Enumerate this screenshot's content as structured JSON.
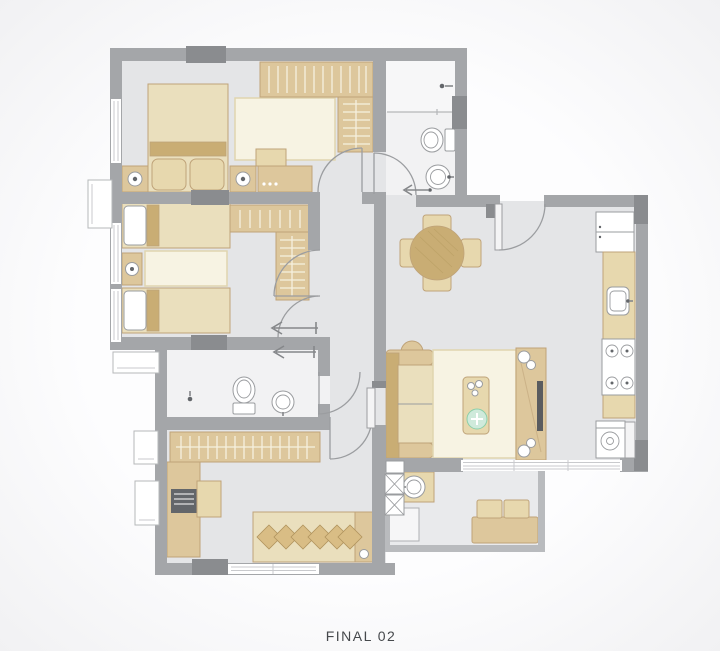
{
  "title": {
    "label": "FINAL 02"
  },
  "colors": {
    "background": "#fdfdfe",
    "backgroundEdge": "#f1f1f3",
    "wall": "#a4a6a9",
    "wallDark": "#8a8c8f",
    "wallLight": "#b9bbbe",
    "floor": "#e4e5e7",
    "floorBalcony": "#e9eaec",
    "bathFloor": "#f2f2f3",
    "showerFloor": "#f7f7f8",
    "tan": "#ddc79c",
    "tanLight": "#eadfbd",
    "tanPale": "#e7d8ae",
    "tanDark": "#c9ad74",
    "tanStroke": "#bfa379",
    "cream": "#f7f3e3",
    "creamStroke": "#e0d5af",
    "fixture": "#9a9c9f",
    "door": "#9b9da0",
    "hanger": "#f6f1df",
    "tableHatch": "#b59a5e",
    "pillow": "#d9bd85",
    "pillowStroke": "#b1945e",
    "plant": "#cfeadb",
    "plantDark": "#8bcfa9",
    "tv": "#5a5c5f",
    "dark": "#63666a",
    "arrow": "#85878a",
    "text": "#46494c"
  },
  "legend": {
    "rooms": [
      "bedroom-1",
      "bedroom-2",
      "bedroom-3",
      "bathroom-1",
      "bathroom-2",
      "hall",
      "dining-area",
      "living-room",
      "kitchen",
      "balcony"
    ],
    "icons": [
      "double-bed-icon",
      "single-bed-icon",
      "wardrobe-icon",
      "nightstand-icon",
      "table-lamp-icon",
      "rug-icon",
      "dresser-icon",
      "toilet-icon",
      "washbasin-icon",
      "shower-head-icon",
      "round-dining-table-icon",
      "dining-chair-icon",
      "sofa-icon",
      "side-table-icon",
      "coffee-table-icon",
      "plant-icon",
      "tv-console-icon",
      "tv-icon",
      "speaker-icon",
      "refrigerator-icon",
      "kitchen-sink-icon",
      "cooktop-icon",
      "washing-machine-icon",
      "balcony-bench-icon",
      "balcony-chair-icon",
      "balcony-sink-icon",
      "service-shaft-icon",
      "desk-icon",
      "printer-icon",
      "door-swing-icon",
      "sliding-door-arrow-icon",
      "window-icon",
      "ac-unit-icon"
    ]
  }
}
